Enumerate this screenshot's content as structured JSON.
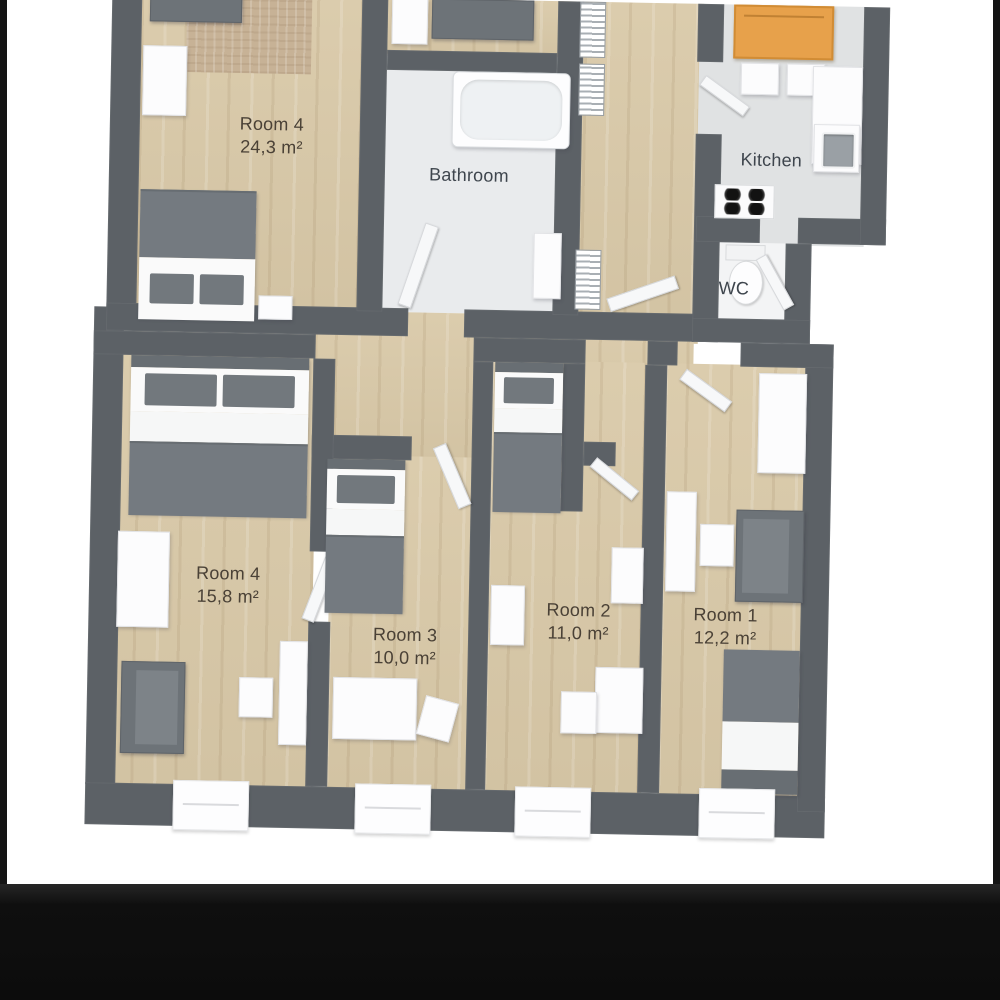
{
  "title": "Apartment floor plan",
  "rooms": {
    "room4_large": {
      "name": "Room 4",
      "area": "24,3 m²"
    },
    "bathroom": {
      "name": "Bathroom"
    },
    "kitchen": {
      "name": "Kitchen"
    },
    "wc": {
      "name": "WC"
    },
    "room4_small": {
      "name": "Room 4",
      "area": "15,8 m²"
    },
    "room3": {
      "name": "Room 3",
      "area": "10,0 m²"
    },
    "room2": {
      "name": "Room 2",
      "area": "11,0 m²"
    },
    "room1": {
      "name": "Room 1",
      "area": "12,2 m²"
    }
  },
  "palette": {
    "wall": "#5c6166",
    "wood_floor": "#d9c9a8",
    "bathroom_floor": "#e9ebed",
    "kitchen_floor": "#e0e2e3",
    "dark_furniture": "#6d7378",
    "white_furniture": "#fcfcfd",
    "dining_table": "#e7a14b",
    "rug": "#c7b296",
    "label_text": "#4a4136",
    "frame_bar": "#141414",
    "background": "#ffffff"
  }
}
